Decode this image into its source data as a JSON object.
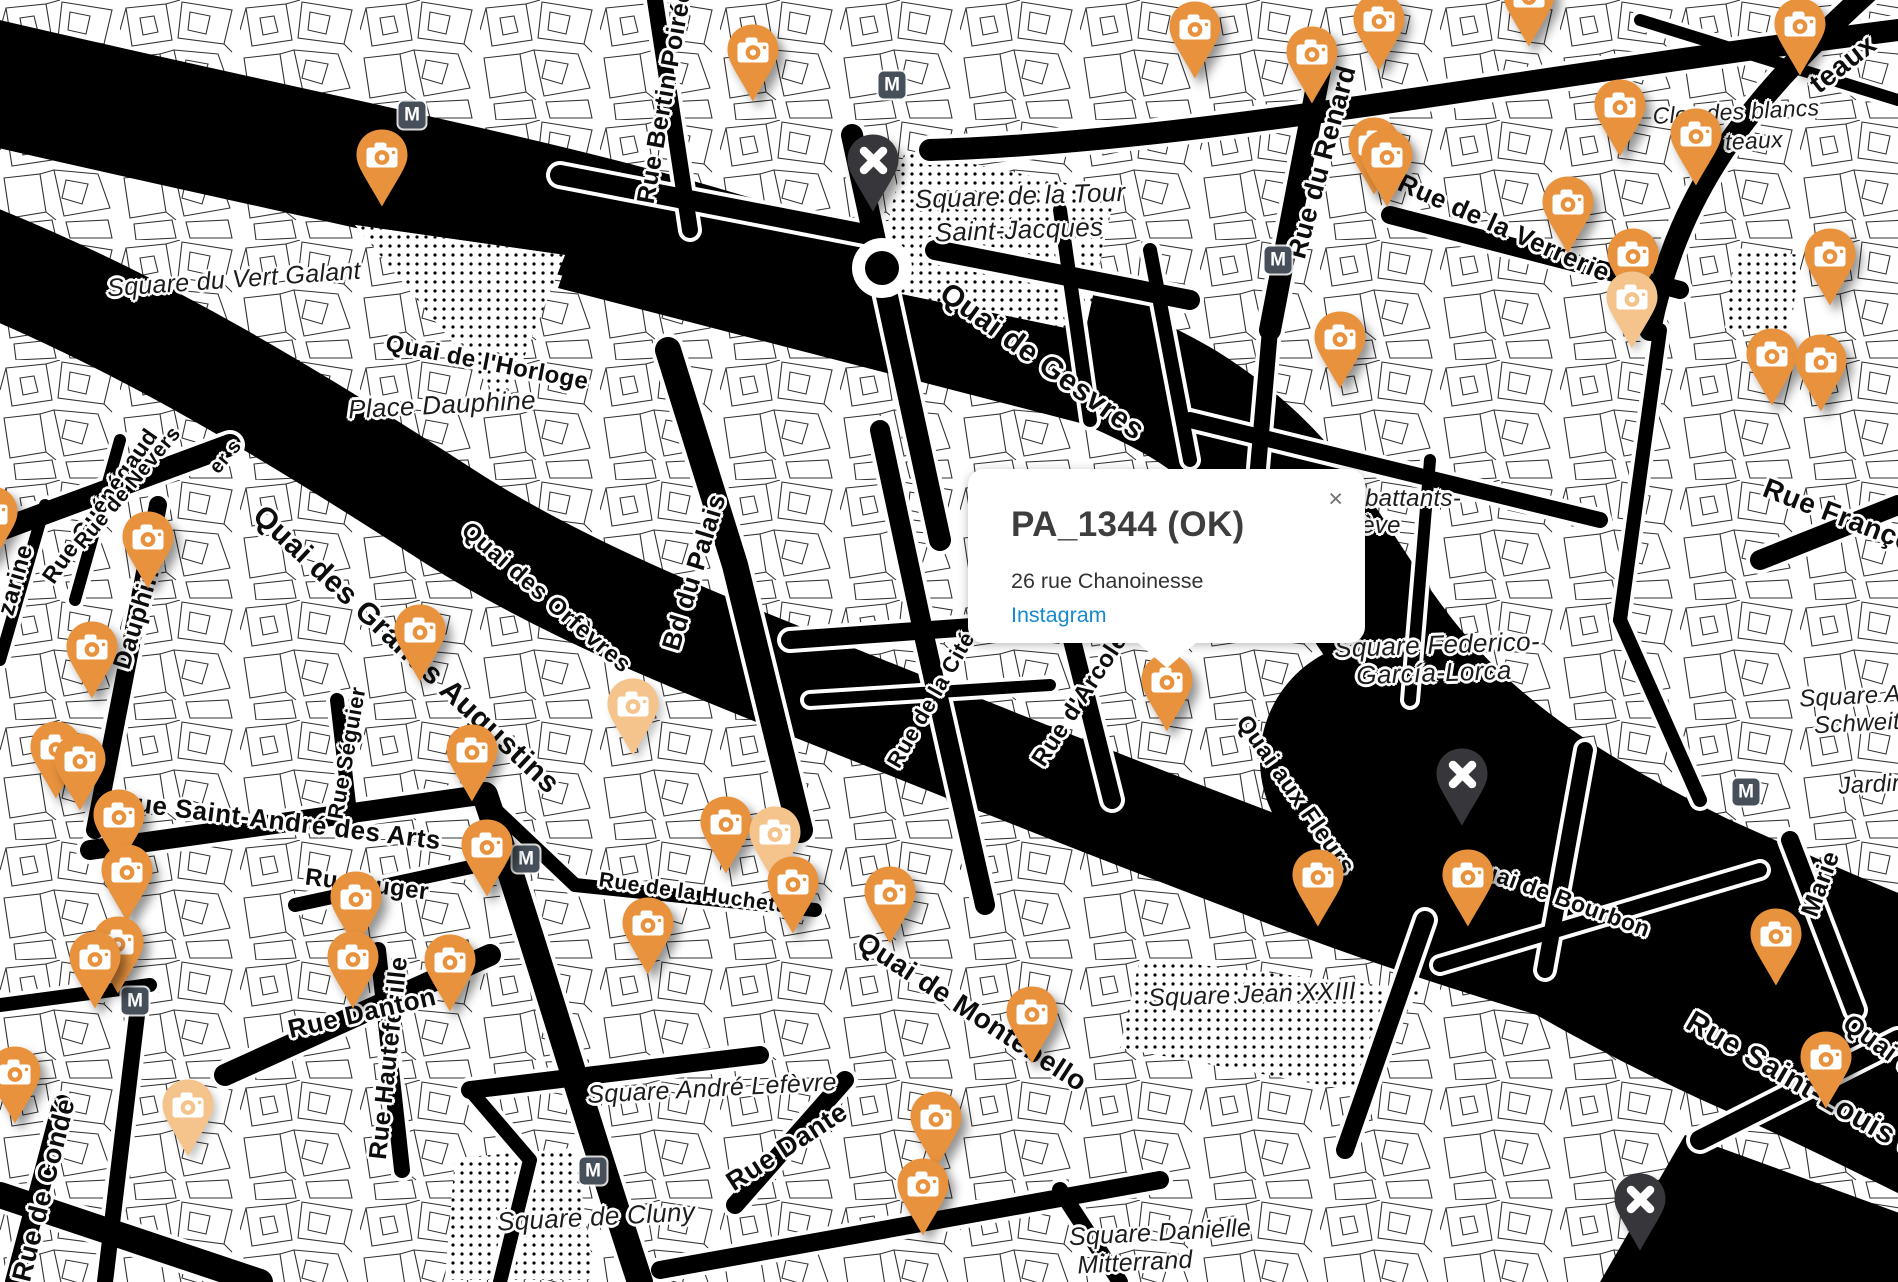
{
  "popup": {
    "title": "PA_1344 (OK)",
    "address": "26 rue Chanoinesse",
    "link_label": "Instagram",
    "close_label": "×"
  },
  "map": {
    "metro_label": "M",
    "colors": {
      "marker_orange": "#E8923D",
      "marker_faded": "#F4C48C",
      "marker_excluded": "#37373B",
      "metro_badge": "#47505A",
      "water": "#000000",
      "instagram_link": "#1789CE",
      "popup_title": "#3E3E3E"
    },
    "street_labels": [
      {
        "text": "Quai de Gesvres",
        "x": 1042,
        "y": 362,
        "rot": 36,
        "size": 30
      },
      {
        "text": "Quai de l'Horloge",
        "x": 487,
        "y": 363,
        "rot": 11,
        "size": 24
      },
      {
        "text": "Quai des Grands Augustins",
        "x": 406,
        "y": 650,
        "rot": 43,
        "size": 30
      },
      {
        "text": "Quai des Orfèvres",
        "x": 546,
        "y": 598,
        "rot": 41,
        "size": 24
      },
      {
        "text": "Bd du Palais",
        "x": 694,
        "y": 572,
        "rot": -73,
        "size": 26
      },
      {
        "text": "Rue Bertin Poirée",
        "x": 665,
        "y": 96,
        "rot": -80,
        "size": 25
      },
      {
        "text": "Rue du Renard",
        "x": 1322,
        "y": 162,
        "rot": -75,
        "size": 27
      },
      {
        "text": "Rue de la Verrerie",
        "x": 1504,
        "y": 228,
        "rot": 24,
        "size": 26
      },
      {
        "text": "Rue Saint-André des Arts",
        "x": 279,
        "y": 821,
        "rot": 7,
        "size": 26
      },
      {
        "text": "Rue Suger",
        "x": 367,
        "y": 885,
        "rot": 7,
        "size": 24
      },
      {
        "text": "Rue Séguier",
        "x": 347,
        "y": 753,
        "rot": -80,
        "size": 22
      },
      {
        "text": "Rue Hautefeuille",
        "x": 389,
        "y": 1058,
        "rot": -84,
        "size": 25
      },
      {
        "text": "Rue Danton",
        "x": 362,
        "y": 1013,
        "rot": -13,
        "size": 26
      },
      {
        "text": "Rue de Condé",
        "x": 44,
        "y": 1190,
        "rot": -76,
        "size": 27
      },
      {
        "text": "Rue Dante",
        "x": 787,
        "y": 1147,
        "rot": -33,
        "size": 27
      },
      {
        "text": "Quai de Montebello",
        "x": 972,
        "y": 1012,
        "rot": 33,
        "size": 28
      },
      {
        "text": "Rue de la Cité",
        "x": 931,
        "y": 700,
        "rot": -60,
        "size": 22
      },
      {
        "text": "Rue d'Arcole",
        "x": 1080,
        "y": 700,
        "rot": -57,
        "size": 24
      },
      {
        "text": "Quai aux Fleurs",
        "x": 1295,
        "y": 795,
        "rot": 55,
        "size": 24
      },
      {
        "text": "Quai de Bourbon",
        "x": 1558,
        "y": 897,
        "rot": 20,
        "size": 23
      },
      {
        "text": "Rue Saint-Louis e",
        "x": 1802,
        "y": 1085,
        "rot": 30,
        "size": 30
      },
      {
        "text": "Quai d",
        "x": 1880,
        "y": 1045,
        "rot": 36,
        "size": 26
      },
      {
        "text": "Marie",
        "x": 1821,
        "y": 884,
        "rot": -70,
        "size": 25
      },
      {
        "text": "Rue François",
        "x": 1850,
        "y": 520,
        "rot": 21,
        "size": 28
      },
      {
        "text": "Rue Guénégaud",
        "x": 100,
        "y": 506,
        "rot": -55,
        "size": 23
      },
      {
        "text": "Rue de Nevers",
        "x": 128,
        "y": 488,
        "rot": -50,
        "size": 21
      },
      {
        "text": "zarine",
        "x": 16,
        "y": 580,
        "rot": -74,
        "size": 24
      },
      {
        "text": "Dauphine",
        "x": 139,
        "y": 612,
        "rot": -73,
        "size": 25
      },
      {
        "text": "Rue de la Huchette",
        "x": 697,
        "y": 894,
        "rot": 8,
        "size": 21
      },
      {
        "text": "teaux",
        "x": 1843,
        "y": 64,
        "rot": -38,
        "size": 28
      },
      {
        "text": "er s",
        "x": 226,
        "y": 457,
        "rot": -50,
        "size": 20
      }
    ],
    "area_labels": [
      {
        "text": "Square de la Tour",
        "x": 1020,
        "y": 196,
        "rot": -2,
        "size": 26
      },
      {
        "text": "Saint-Jacques",
        "x": 1019,
        "y": 230,
        "rot": -2,
        "size": 26
      },
      {
        "text": "Square du Vert Galant",
        "x": 234,
        "y": 280,
        "rot": -4,
        "size": 25
      },
      {
        "text": "Place Dauphine",
        "x": 442,
        "y": 405,
        "rot": -3,
        "size": 26
      },
      {
        "text": "Square Federico-",
        "x": 1437,
        "y": 645,
        "rot": -2,
        "size": 26
      },
      {
        "text": "García-Lorca",
        "x": 1434,
        "y": 673,
        "rot": -2,
        "size": 26
      },
      {
        "text": "battants-",
        "x": 1413,
        "y": 499,
        "rot": 0,
        "size": 24
      },
      {
        "text": "ève",
        "x": 1381,
        "y": 526,
        "rot": 0,
        "size": 24
      },
      {
        "text": "Square André Lefèvre",
        "x": 712,
        "y": 1089,
        "rot": -3,
        "size": 25
      },
      {
        "text": "Square de Cluny",
        "x": 596,
        "y": 1217,
        "rot": -3,
        "size": 26
      },
      {
        "text": "Square Jean XXIII",
        "x": 1252,
        "y": 995,
        "rot": -2,
        "size": 25
      },
      {
        "text": "Square Danielle",
        "x": 1160,
        "y": 1233,
        "rot": -3,
        "size": 25
      },
      {
        "text": "Mitterrand",
        "x": 1135,
        "y": 1263,
        "rot": -3,
        "size": 25
      },
      {
        "text": "Square A",
        "x": 1850,
        "y": 697,
        "rot": -3,
        "size": 24
      },
      {
        "text": "Schweit",
        "x": 1857,
        "y": 724,
        "rot": -3,
        "size": 24
      },
      {
        "text": "Jardin",
        "x": 1872,
        "y": 785,
        "rot": -3,
        "size": 24
      },
      {
        "text": "Clos des blancs",
        "x": 1736,
        "y": 112,
        "rot": -3,
        "size": 23
      },
      {
        "text": "teaux",
        "x": 1754,
        "y": 141,
        "rot": -3,
        "size": 23
      }
    ],
    "camera_markers": [
      {
        "x": 753,
        "y": 103
      },
      {
        "x": 1195,
        "y": 80
      },
      {
        "x": 1312,
        "y": 105
      },
      {
        "x": 1379,
        "y": 72
      },
      {
        "x": 1529,
        "y": 48
      },
      {
        "x": 1800,
        "y": 77
      },
      {
        "x": 1620,
        "y": 158
      },
      {
        "x": 1696,
        "y": 187
      },
      {
        "x": 1374,
        "y": 196
      },
      {
        "x": 1387,
        "y": 208
      },
      {
        "x": 1568,
        "y": 255
      },
      {
        "x": 1830,
        "y": 307
      },
      {
        "x": 1633,
        "y": 307
      },
      {
        "x": 1632,
        "y": 350,
        "faded": true
      },
      {
        "x": 1772,
        "y": 407
      },
      {
        "x": 1821,
        "y": 413
      },
      {
        "x": 1340,
        "y": 390
      },
      {
        "x": 382,
        "y": 208
      },
      {
        "x": 148,
        "y": 590
      },
      {
        "x": 92,
        "y": 700
      },
      {
        "x": 420,
        "y": 683
      },
      {
        "x": 633,
        "y": 757,
        "faded": true
      },
      {
        "x": -8,
        "y": 565
      },
      {
        "x": 56,
        "y": 800
      },
      {
        "x": 80,
        "y": 812
      },
      {
        "x": 472,
        "y": 803
      },
      {
        "x": 487,
        "y": 898
      },
      {
        "x": 119,
        "y": 868
      },
      {
        "x": 127,
        "y": 923
      },
      {
        "x": 118,
        "y": 995
      },
      {
        "x": 95,
        "y": 1010
      },
      {
        "x": 15,
        "y": 1125
      },
      {
        "x": 188,
        "y": 1158,
        "faded": true
      },
      {
        "x": 356,
        "y": 950
      },
      {
        "x": 353,
        "y": 1010
      },
      {
        "x": 450,
        "y": 1013
      },
      {
        "x": 726,
        "y": 875
      },
      {
        "x": 775,
        "y": 885,
        "faded": true
      },
      {
        "x": 793,
        "y": 935
      },
      {
        "x": 648,
        "y": 976
      },
      {
        "x": 890,
        "y": 945
      },
      {
        "x": 1032,
        "y": 1065
      },
      {
        "x": 936,
        "y": 1170
      },
      {
        "x": 923,
        "y": 1237
      },
      {
        "x": 1167,
        "y": 733
      },
      {
        "x": 1318,
        "y": 928
      },
      {
        "x": 1468,
        "y": 928
      },
      {
        "x": 1776,
        "y": 987
      },
      {
        "x": 1826,
        "y": 1110
      }
    ],
    "excluded_markers": [
      {
        "x": 873,
        "y": 213
      },
      {
        "x": 1462,
        "y": 827
      },
      {
        "x": 1640,
        "y": 1252
      }
    ],
    "metro_stations": [
      {
        "x": 412,
        "y": 115
      },
      {
        "x": 892,
        "y": 85
      },
      {
        "x": 1278,
        "y": 260
      },
      {
        "x": 526,
        "y": 859
      },
      {
        "x": 135,
        "y": 1001
      },
      {
        "x": 593,
        "y": 1171
      },
      {
        "x": 1746,
        "y": 792
      }
    ]
  }
}
